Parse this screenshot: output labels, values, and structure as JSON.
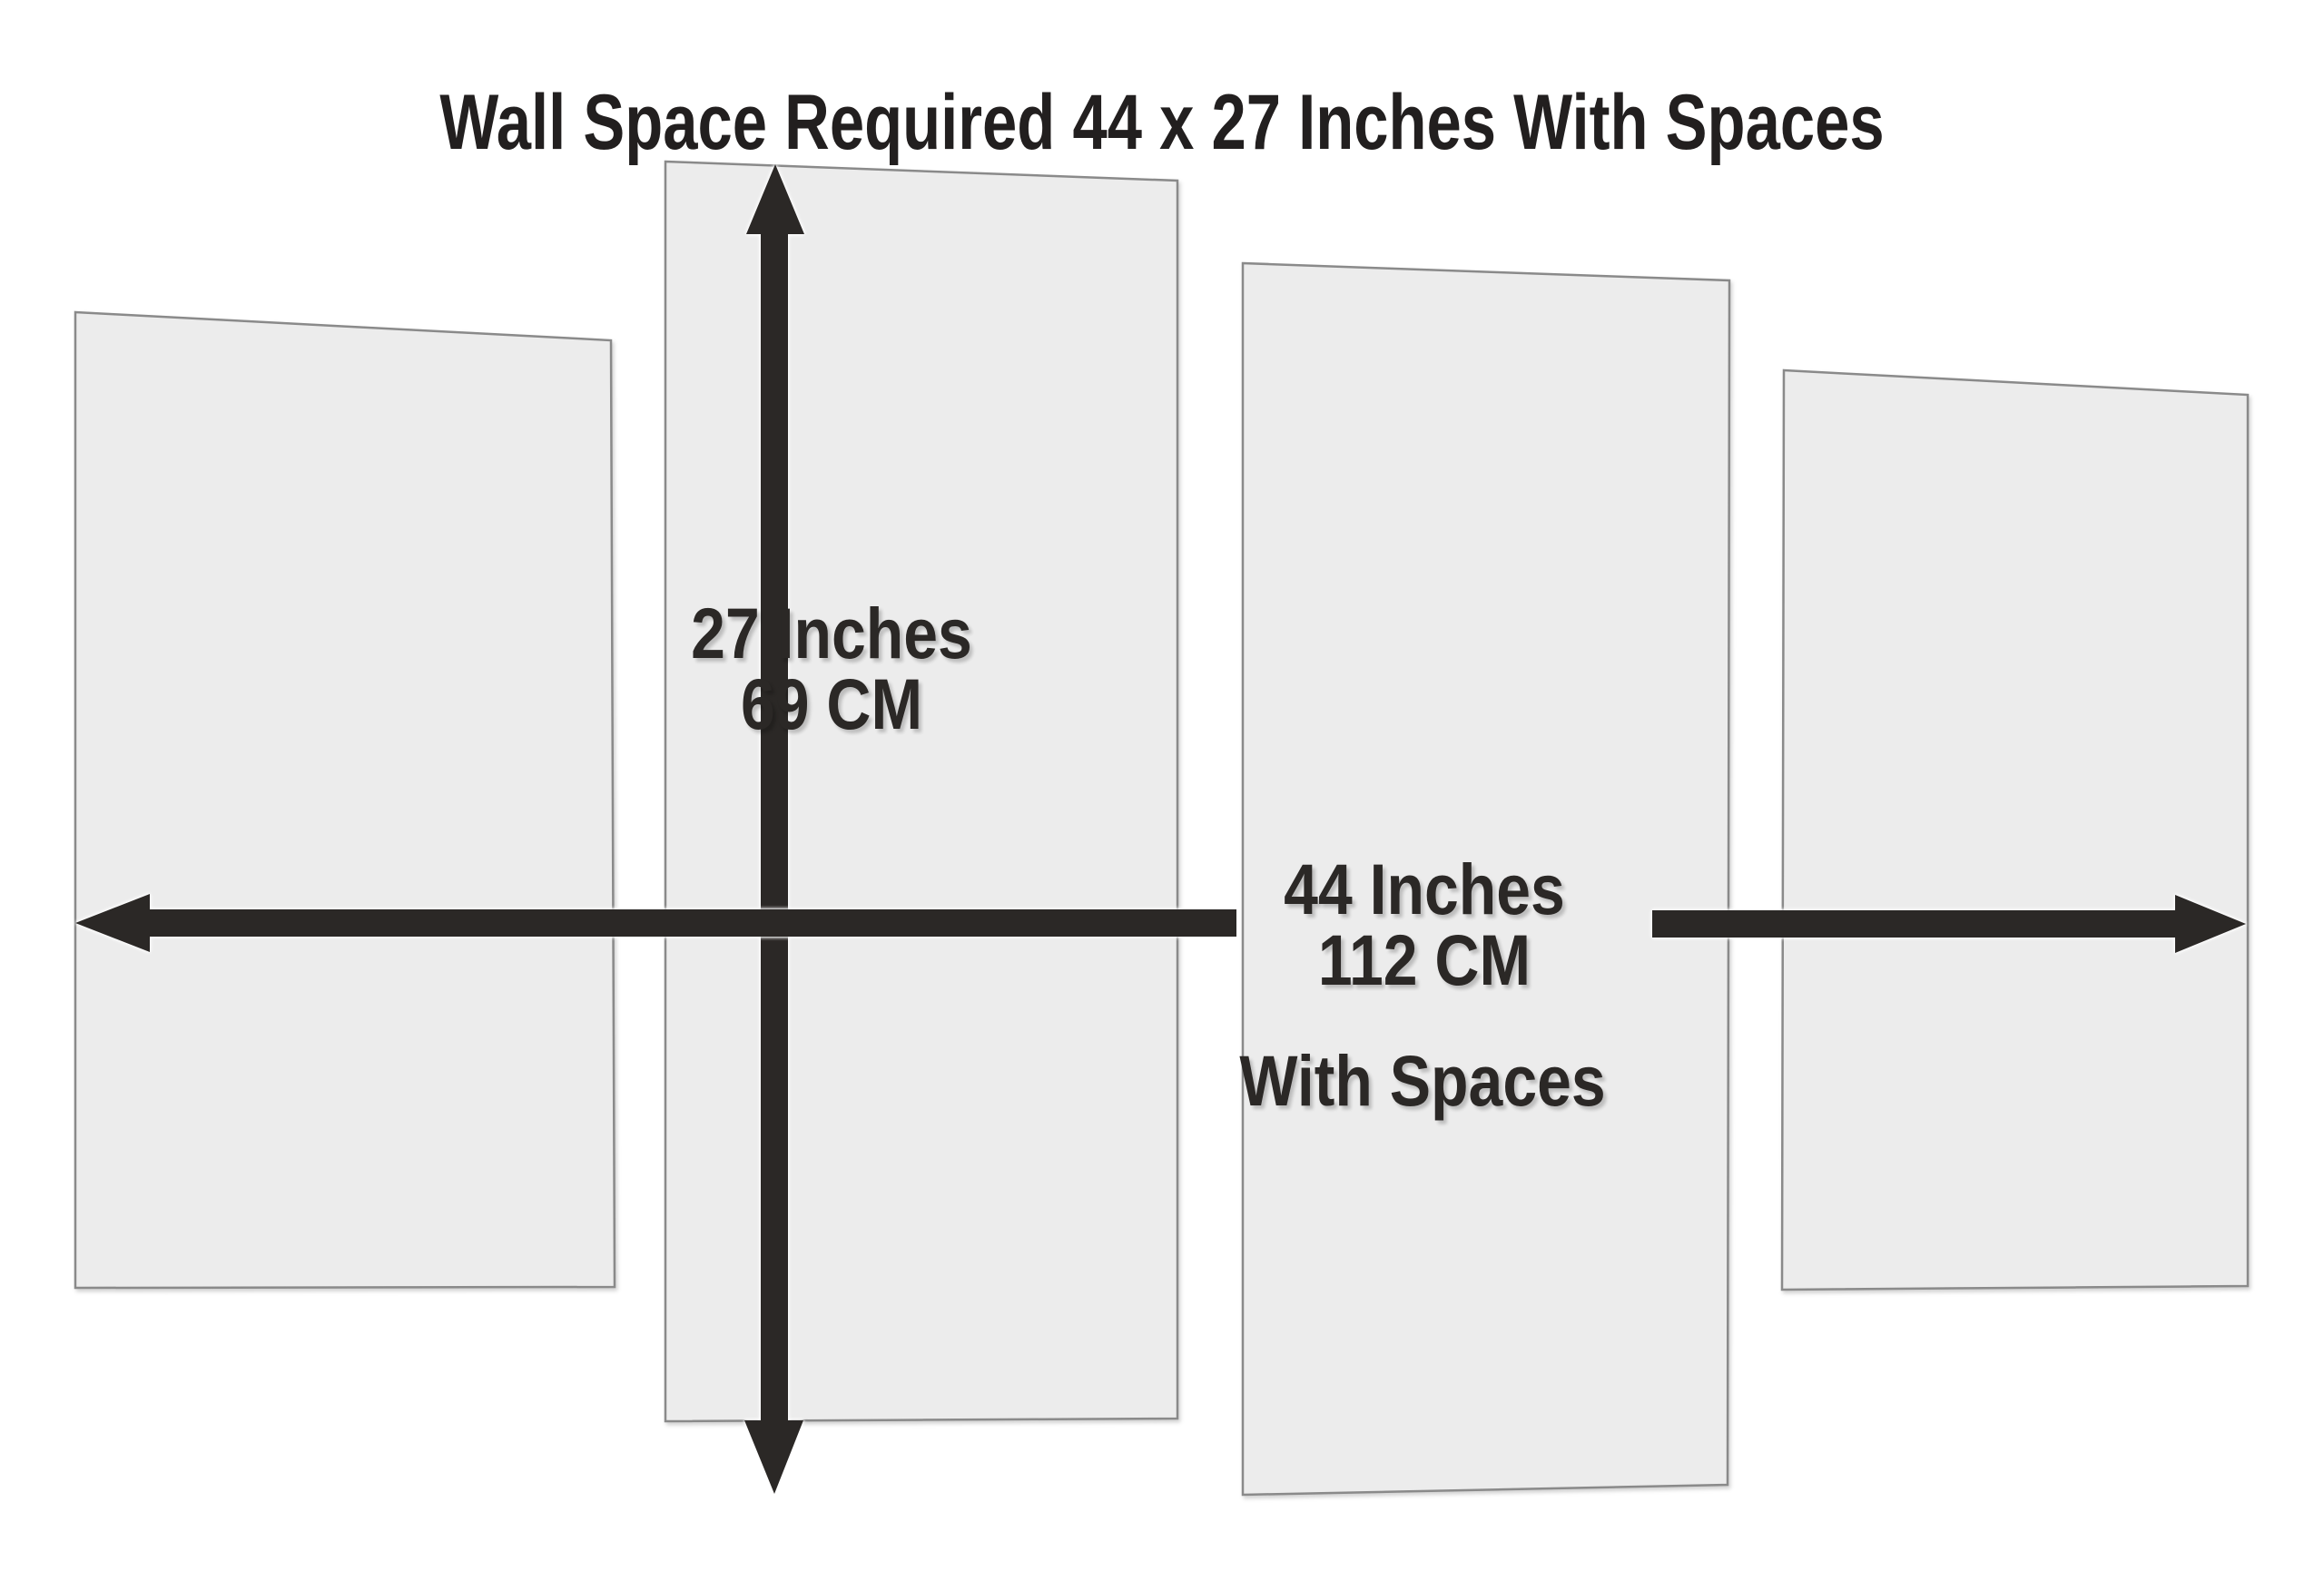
{
  "title": "Wall Space Required 44 x 27 Inches With Spaces",
  "vertical_dimension": {
    "inches": "27 Inches",
    "cm": "69 CM"
  },
  "horizontal_dimension": {
    "inches": "44 Inches",
    "cm": "112 CM",
    "note": "With Spaces"
  },
  "panels": {
    "count": "4",
    "fill_color": "#ececec",
    "border_color": "#8a8a8a"
  },
  "colors": {
    "background": "#ffffff",
    "arrow": "#2b2826",
    "text": "#2b2826"
  }
}
